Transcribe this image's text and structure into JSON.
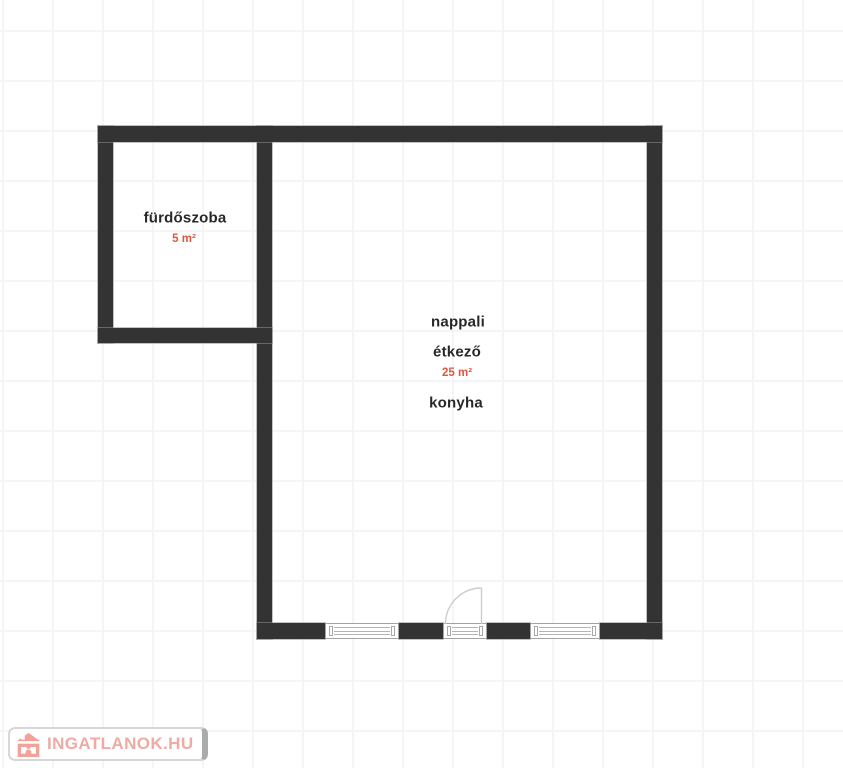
{
  "floorplan": {
    "rooms": {
      "bathroom": {
        "label": "fürdőszoba",
        "area": "5 m²"
      },
      "living": {
        "label_line1": "nappali",
        "label_line2": "étkező",
        "area": "25 m²",
        "label_line3": "konyha"
      }
    },
    "symbols": {
      "windows_count": "2",
      "balcony_door": "door with quarter-circle swing arc on bottom wall"
    },
    "colors": {
      "wall": "#333333",
      "room_label_text": "#282828",
      "area_label_text": "#e05740",
      "grid_line": "#f5f5f5",
      "window_outline": "#a3a3a3",
      "door_arc": "#cccccc"
    }
  },
  "watermark": {
    "text": "INGATLANOK.HU",
    "text_color": "#eeaba4",
    "icon_color": "#f2a29b",
    "icon": "house-icon"
  }
}
